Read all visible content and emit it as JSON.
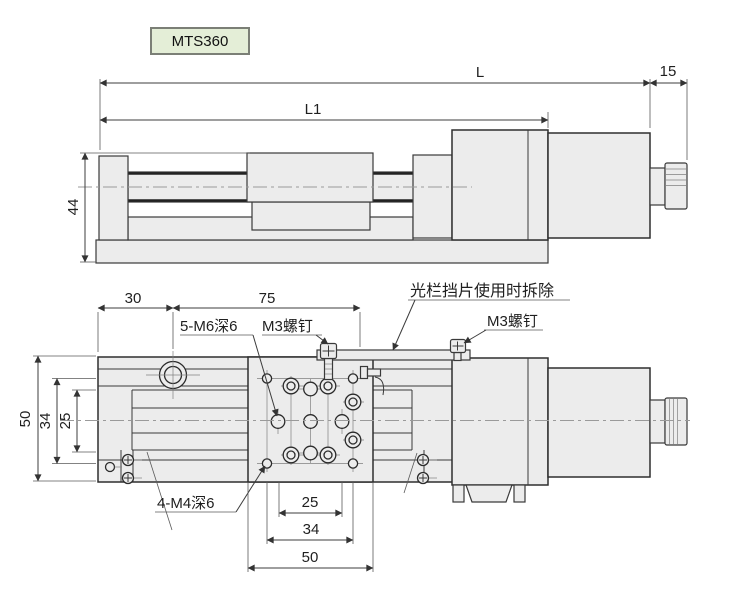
{
  "model": {
    "label": "MTS360"
  },
  "colors": {
    "background": "#ffffff",
    "part_fill": "#ececec",
    "outline": "#3a3a3a",
    "badge_fill": "#e4eed7",
    "badge_border": "#7b7f76",
    "centerline": "#9a9a9a",
    "text": "#1f1f1f"
  },
  "side_view": {
    "title": "side elevation view",
    "dims": {
      "overall_length": "L",
      "body_length": "L1",
      "connector_length": "15",
      "height": "44"
    }
  },
  "plan_view": {
    "title": "top plan view",
    "dims": {
      "left_offset": "30",
      "sensor_offset": "75",
      "width_left": "50",
      "m4_row_span_left": "34",
      "m6_row_span_left": "25",
      "m6_col_span_bottom": "25",
      "m4_col_span_bottom": "34",
      "table_width_bottom": "50"
    },
    "labels": {
      "m6_holes": "5-M6深6",
      "m3_screw_left": "M3螺钉",
      "shutter_note": "光栏挡片使用时拆除",
      "m3_screw_right": "M3螺钉",
      "m4_holes": "4-M4深6"
    }
  }
}
